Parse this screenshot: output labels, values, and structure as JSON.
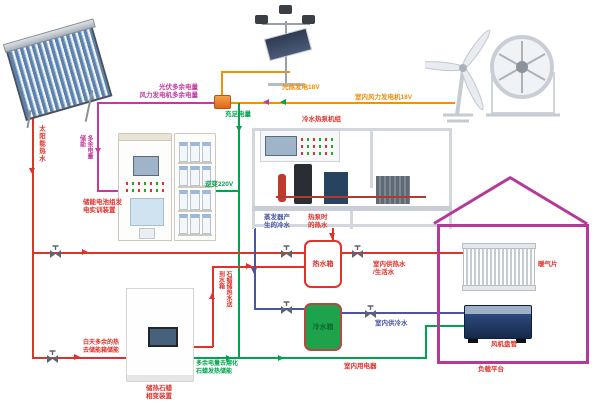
{
  "diagram_title": "太阳能/风能冷热电联供系统示意图",
  "colors": {
    "hot_water_pipe": "#e0312a",
    "cold_water_pipe": "#4a56a5",
    "power_sufficient_wire": "#00a34e",
    "power_excess_wire": "#c23a9e",
    "generator_wire": "#f29200",
    "house_outline": "#b5399b",
    "cold_tank_fill": "#1fa24c"
  },
  "power": {
    "pv_output": "光热发电18V",
    "wind_output": "室内风力发电机18V",
    "excess_pv": "光伏多余电量",
    "excess_wind": "风力发电机多余电量",
    "sufficient": "充足电量",
    "excess_storage": "多余电量储能",
    "inverter": "逆变220V",
    "indoor_appliances": "室内用电器",
    "melt_line1": "多余电量去熔化",
    "melt_line2": "石蜡发热储能"
  },
  "water": {
    "solar_hot": "太阳能热水",
    "evap_line1": "蒸发器产",
    "evap_line2": "生的冷水",
    "hp_line1": "热泵时",
    "hp_line2": "的热水",
    "hot_tank": "热水箱",
    "cold_tank": "冷水箱",
    "indoor_hot1": "室内供热水",
    "indoor_hot2": "/生活水",
    "indoor_cold": "室内供冷水",
    "paraffin_return": "石蜡储热水送到水箱",
    "day_excess1": "白天多余的热",
    "day_excess2": "去储能箱储能"
  },
  "devices": {
    "battery_line1": "储能电池组发",
    "battery_line2": "电实训装置",
    "chiller": "冷水热泵机组",
    "paraffin_line1": "储热石蜡",
    "paraffin_line2": "相变装置",
    "radiator": "暖气片",
    "fancoil": "风机盘管",
    "load_platform": "负载平台"
  }
}
